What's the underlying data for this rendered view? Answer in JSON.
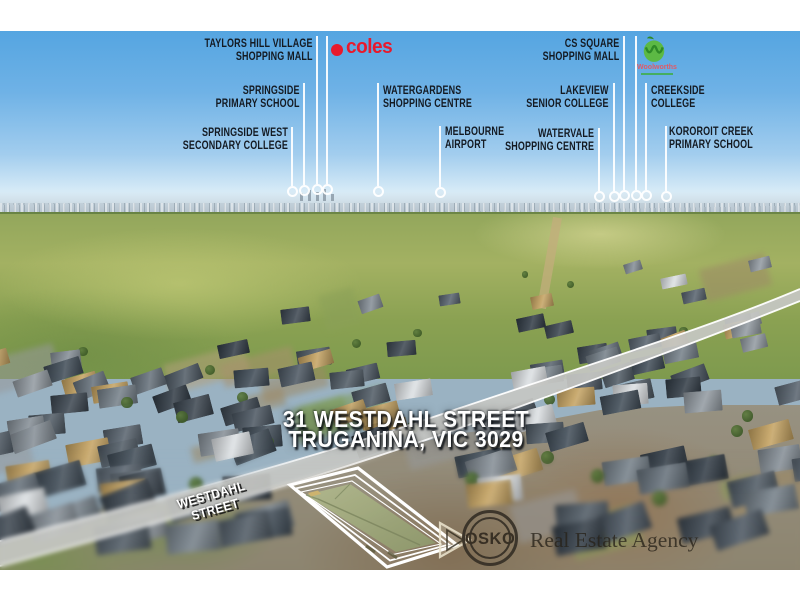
{
  "landmark_labels": [
    {
      "name": "taylors-hill-village",
      "line1": "TAYLORS HILL VILLAGE",
      "line2": "SHOPPING MALL"
    },
    {
      "name": "springside-primary",
      "line1": "SPRINGSIDE",
      "line2": "PRIMARY SCHOOL"
    },
    {
      "name": "springside-west",
      "line1": "SPRINGSIDE WEST",
      "line2": "SECONDARY COLLEGE"
    },
    {
      "name": "watergardens",
      "line1": "WATERGARDENS",
      "line2": "SHOPPING CENTRE"
    },
    {
      "name": "melbourne-airport",
      "line1": "MELBOURNE",
      "line2": "AIRPORT"
    },
    {
      "name": "cs-square",
      "line1": "CS SQUARE",
      "line2": "SHOPPING MALL"
    },
    {
      "name": "lakeview",
      "line1": "LAKEVIEW",
      "line2": "SENIOR COLLEGE"
    },
    {
      "name": "watervale",
      "line1": "WATERVALE",
      "line2": "SHOPPING CENTRE"
    },
    {
      "name": "creekside",
      "line1": "CREEKSIDE",
      "line2": "COLLEGE"
    },
    {
      "name": "kororoit",
      "line1": "KOROROIT CREEK",
      "line2": "PRIMARY SCHOOL"
    }
  ],
  "brands": {
    "coles": "coles",
    "woolworths": "Woolworths"
  },
  "address": {
    "line1": "31 WESTDAHL STREET",
    "line2": "TRUGANINA, VIC 3029"
  },
  "street_label": "WESTDAHL STREET",
  "agency": {
    "name": "OSKO",
    "tagline": "Real Estate Agency"
  },
  "colors": {
    "sky_top": "#55a5e1",
    "field_green": "#9fae64",
    "coles_red": "#e8192c",
    "woolworths_green": "#5cb944",
    "label_text": "#141a22",
    "highlight_outline": "#ffffff"
  }
}
